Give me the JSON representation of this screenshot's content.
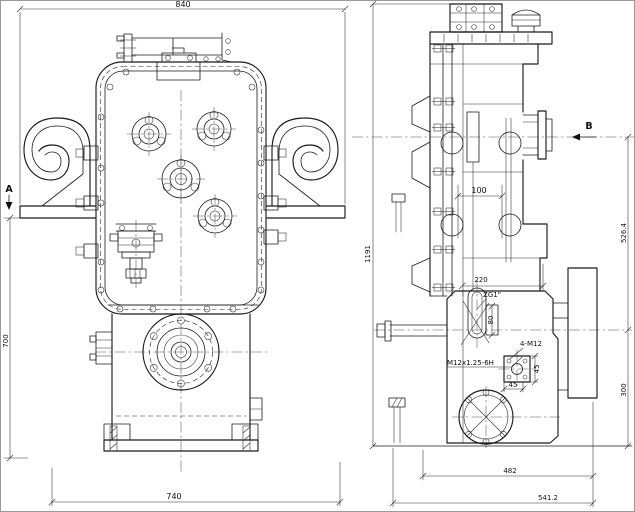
{
  "drawing": {
    "background": "#ffffff",
    "line_color": "#1b1b1b",
    "views": {
      "front": {
        "section_label": "A",
        "dims": {
          "overall_width": "840",
          "height": "700",
          "base_width": "740"
        }
      },
      "side": {
        "section_label": "B",
        "dims": {
          "overall_height": "1191",
          "upper_height": "526.4",
          "lower_height": "300",
          "shaft_offset": "100",
          "top_width": "220",
          "boss_height": "80",
          "square_height": "45",
          "square_width": "45",
          "base_width": "482",
          "overall_depth": "541.2"
        },
        "callouts": {
          "pipe_thread": "ZG1\"",
          "bolt_pattern": "4-M12",
          "thread_spec": "M12x1.25-6H"
        }
      }
    }
  }
}
